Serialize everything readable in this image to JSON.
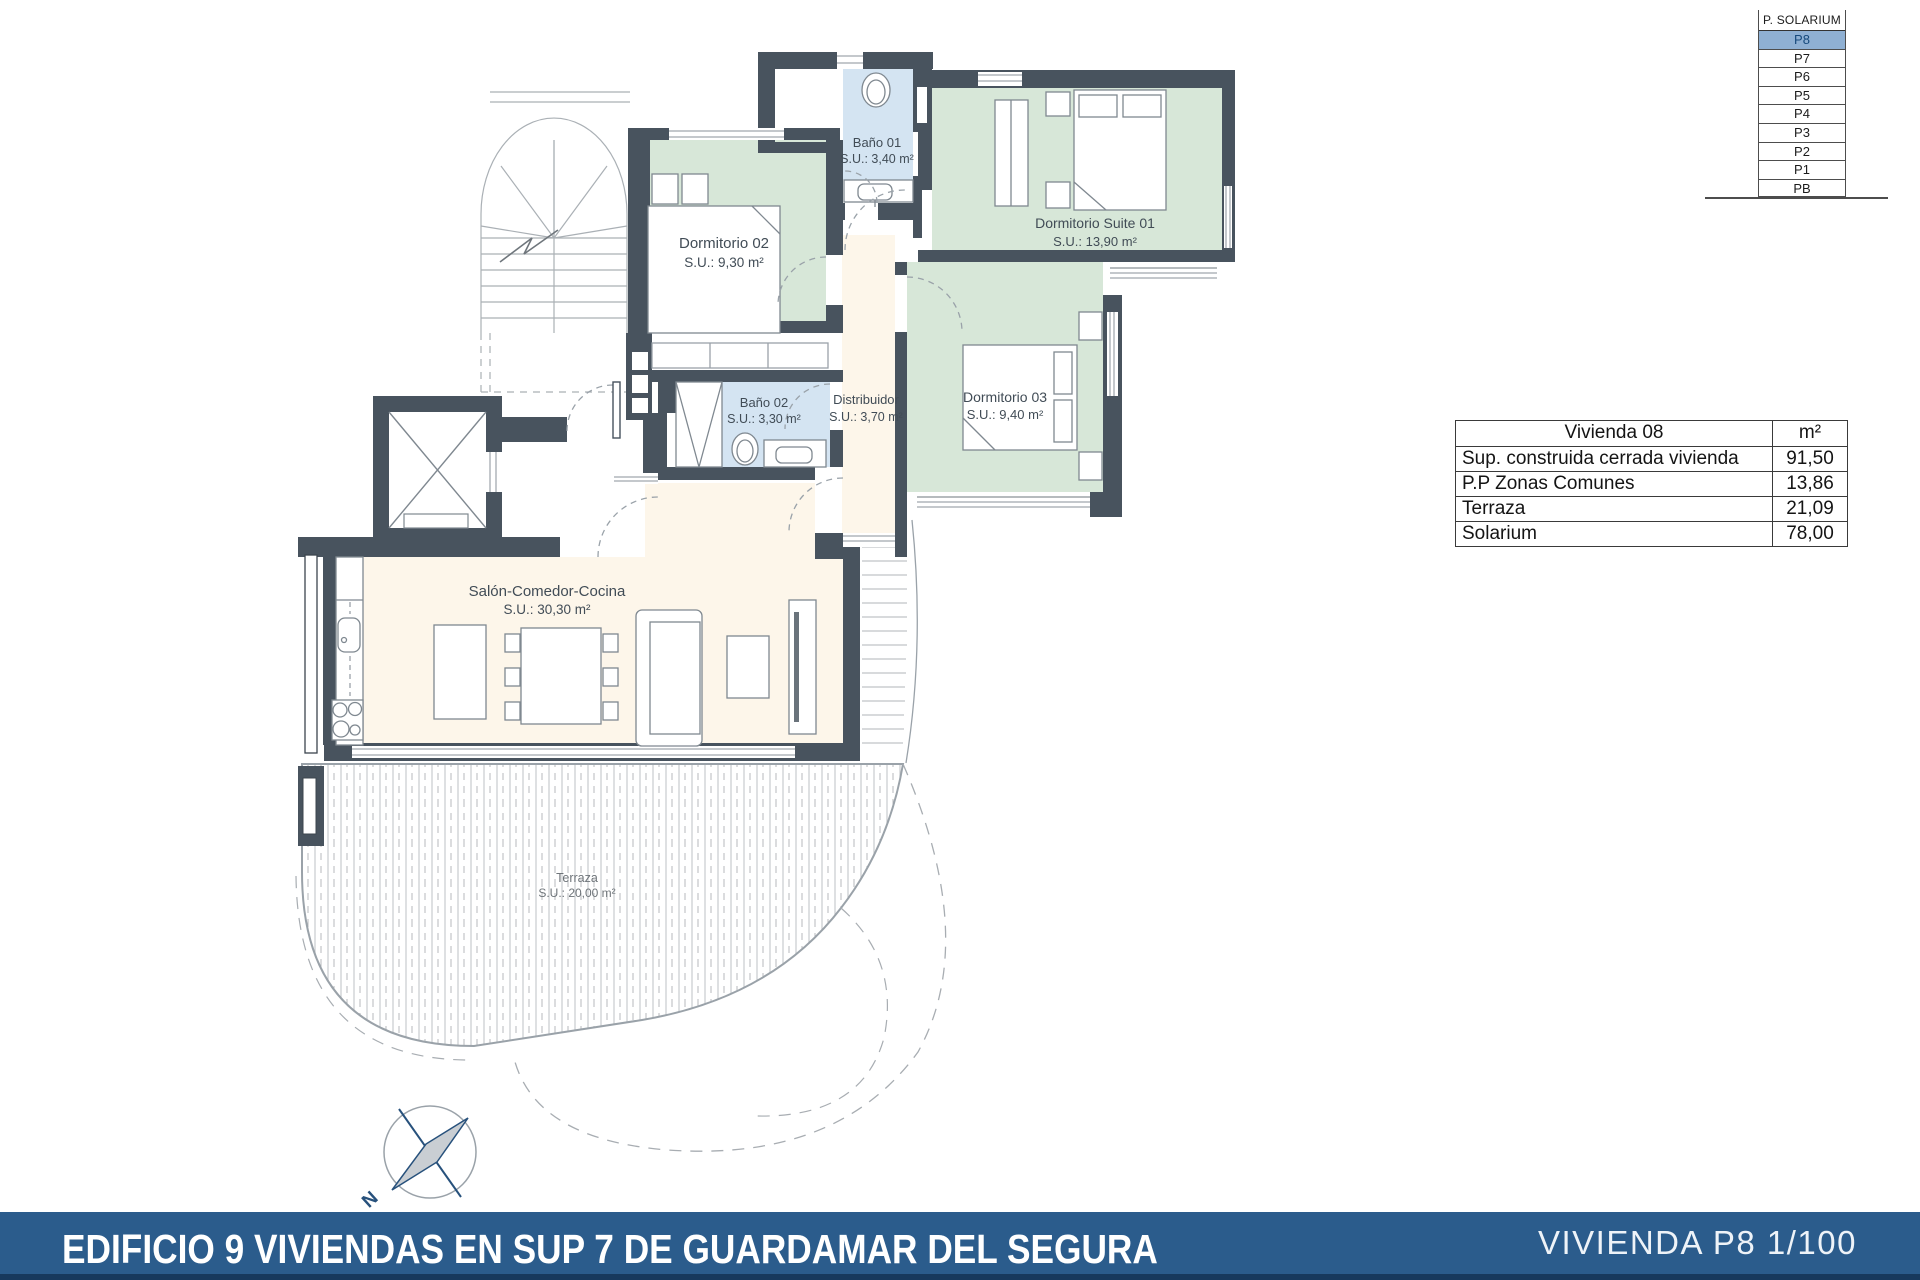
{
  "floor_selector": {
    "levels": [
      "P. SOLARIUM",
      "P8",
      "P7",
      "P6",
      "P5",
      "P4",
      "P3",
      "P2",
      "P1",
      "PB"
    ],
    "selected": "P8",
    "highlight_color": "#8fb0d3"
  },
  "area_table": {
    "title": "Vivienda 08",
    "unit_header": "m²",
    "rows": [
      {
        "label": "Sup. construida cerrada vivienda",
        "value": "91,50"
      },
      {
        "label": "P.P Zonas Comunes",
        "value": "13,86"
      },
      {
        "label": "Terraza",
        "value": "21,09"
      },
      {
        "label": "Solarium",
        "value": "78,00"
      }
    ]
  },
  "plan": {
    "rooms": [
      {
        "name": "Baño 01",
        "area": "S.U.: 3,40 m²"
      },
      {
        "name": "Dormitorio 02",
        "area": "S.U.: 9,30 m²"
      },
      {
        "name": "Dormitorio Suite 01",
        "area": "S.U.: 13,90 m²"
      },
      {
        "name": "Dormitorio 03",
        "area": "S.U.: 9,40 m²"
      },
      {
        "name": "Baño 02",
        "area": "S.U.: 3,30 m²"
      },
      {
        "name": "Distribuidor",
        "area": "S.U.: 3,70 m²"
      },
      {
        "name": "Salón-Comedor-Cocina",
        "area": "S.U.: 30,30 m²"
      },
      {
        "name": "Terraza",
        "area": "S.U.: 20,00 m²"
      }
    ],
    "compass_label": "N"
  },
  "footer": {
    "title": "EDIFICIO 9 VIVIENDAS EN SUP 7 DE GUARDAMAR DEL SEGURA",
    "sheet": "VIVIENDA P8 1/100"
  },
  "colors": {
    "wall": "#48535e",
    "bedroom_fill": "#d7e7d8",
    "bathroom_fill": "#d4e4f2",
    "living_fill": "#fdf6ea",
    "banner_blue": "#2b5c8c",
    "selector_highlight": "#8fb0d3"
  }
}
